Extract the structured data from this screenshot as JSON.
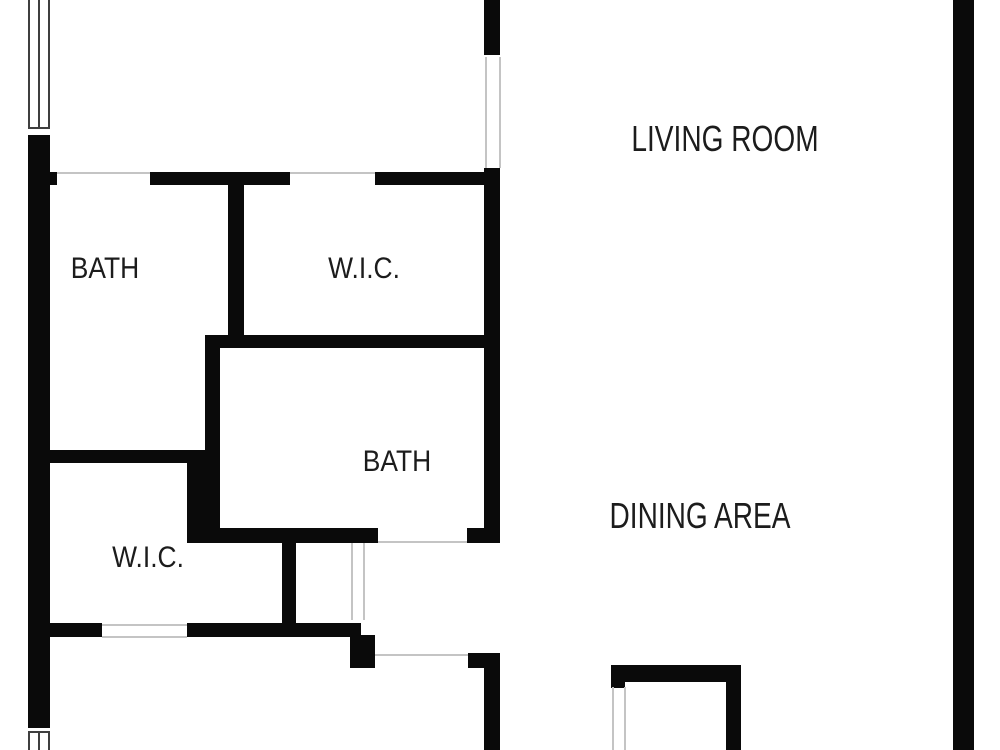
{
  "page": {
    "background": "#ffffff",
    "width": 1000,
    "height": 750
  },
  "floor_plan": {
    "wall_color": "#0a0a0a",
    "opening_line_color": "#c4c4c4",
    "window_line_color": "#3f3f3f",
    "label_color": "#1c1c1c",
    "rooms": [
      {
        "id": "living-room",
        "label": "LIVING ROOM",
        "cx": 725,
        "cy": 139,
        "size": "large"
      },
      {
        "id": "dining-area",
        "label": "DINING AREA",
        "cx": 700,
        "cy": 516,
        "size": "large"
      },
      {
        "id": "bath-1",
        "label": "BATH",
        "cx": 105,
        "cy": 269,
        "size": "small"
      },
      {
        "id": "wic-1",
        "label": "W.I.C.",
        "cx": 364,
        "cy": 269,
        "size": "small"
      },
      {
        "id": "bath-2",
        "label": "BATH",
        "cx": 397,
        "cy": 462,
        "size": "small"
      },
      {
        "id": "wic-2",
        "label": "W.I.C.",
        "cx": 148,
        "cy": 558,
        "size": "small"
      }
    ],
    "walls": [
      {
        "x": 28,
        "y": 135,
        "w": 22,
        "h": 593
      },
      {
        "x": 50,
        "y": 172,
        "w": 7,
        "h": 13
      },
      {
        "x": 150,
        "y": 172,
        "w": 140,
        "h": 13
      },
      {
        "x": 375,
        "y": 172,
        "w": 122,
        "h": 13
      },
      {
        "x": 228,
        "y": 185,
        "w": 16,
        "h": 152
      },
      {
        "x": 484,
        "y": 0,
        "w": 16,
        "h": 55
      },
      {
        "x": 484,
        "y": 168,
        "w": 16,
        "h": 375
      },
      {
        "x": 467,
        "y": 528,
        "w": 17,
        "h": 15
      },
      {
        "x": 205,
        "y": 335,
        "w": 282,
        "h": 13
      },
      {
        "x": 205,
        "y": 348,
        "w": 15,
        "h": 115
      },
      {
        "x": 49,
        "y": 450,
        "w": 158,
        "h": 13
      },
      {
        "x": 187,
        "y": 460,
        "w": 33,
        "h": 83
      },
      {
        "x": 220,
        "y": 528,
        "w": 158,
        "h": 15
      },
      {
        "x": 282,
        "y": 543,
        "w": 14,
        "h": 89
      },
      {
        "x": 49,
        "y": 623,
        "w": 53,
        "h": 14
      },
      {
        "x": 187,
        "y": 623,
        "w": 174,
        "h": 14
      },
      {
        "x": 350,
        "y": 635,
        "w": 25,
        "h": 33
      },
      {
        "x": 468,
        "y": 653,
        "w": 16,
        "h": 15
      },
      {
        "x": 484,
        "y": 653,
        "w": 16,
        "h": 97
      },
      {
        "x": 611,
        "y": 665,
        "w": 130,
        "h": 17
      },
      {
        "x": 611,
        "y": 682,
        "w": 14,
        "h": 6
      },
      {
        "x": 726,
        "y": 682,
        "w": 15,
        "h": 68
      },
      {
        "x": 953,
        "y": 0,
        "w": 21,
        "h": 750
      }
    ],
    "openings": [
      {
        "type": "h",
        "x": 57,
        "y": 172,
        "len": 93
      },
      {
        "type": "h",
        "x": 290,
        "y": 172,
        "len": 85
      },
      {
        "type": "v",
        "x": 485,
        "y": 57,
        "len": 111
      },
      {
        "type": "v",
        "x": 499,
        "y": 57,
        "len": 111
      },
      {
        "type": "h",
        "x": 378,
        "y": 541,
        "len": 89
      },
      {
        "type": "h",
        "x": 375,
        "y": 654,
        "len": 93
      },
      {
        "type": "h",
        "x": 102,
        "y": 624,
        "len": 85
      },
      {
        "type": "h",
        "x": 102,
        "y": 636,
        "len": 85
      },
      {
        "type": "v",
        "x": 351,
        "y": 543,
        "len": 77
      },
      {
        "type": "v",
        "x": 363,
        "y": 543,
        "len": 77
      },
      {
        "type": "v",
        "x": 612,
        "y": 687,
        "len": 63
      },
      {
        "type": "v",
        "x": 624,
        "y": 687,
        "len": 63
      }
    ],
    "windows": [
      {
        "id": "window-top-left",
        "lines": [
          {
            "type": "v",
            "x": 28,
            "y": 0,
            "len": 128
          },
          {
            "type": "v",
            "x": 38,
            "y": 0,
            "len": 128
          },
          {
            "type": "v",
            "x": 48,
            "y": 0,
            "len": 128
          },
          {
            "type": "h",
            "x": 28,
            "y": 127,
            "len": 22
          }
        ]
      },
      {
        "id": "window-bottom-left",
        "lines": [
          {
            "type": "h",
            "x": 28,
            "y": 731,
            "len": 22
          },
          {
            "type": "v",
            "x": 28,
            "y": 733,
            "len": 17
          },
          {
            "type": "v",
            "x": 38,
            "y": 733,
            "len": 17
          },
          {
            "type": "v",
            "x": 48,
            "y": 733,
            "len": 17
          }
        ]
      }
    ]
  }
}
